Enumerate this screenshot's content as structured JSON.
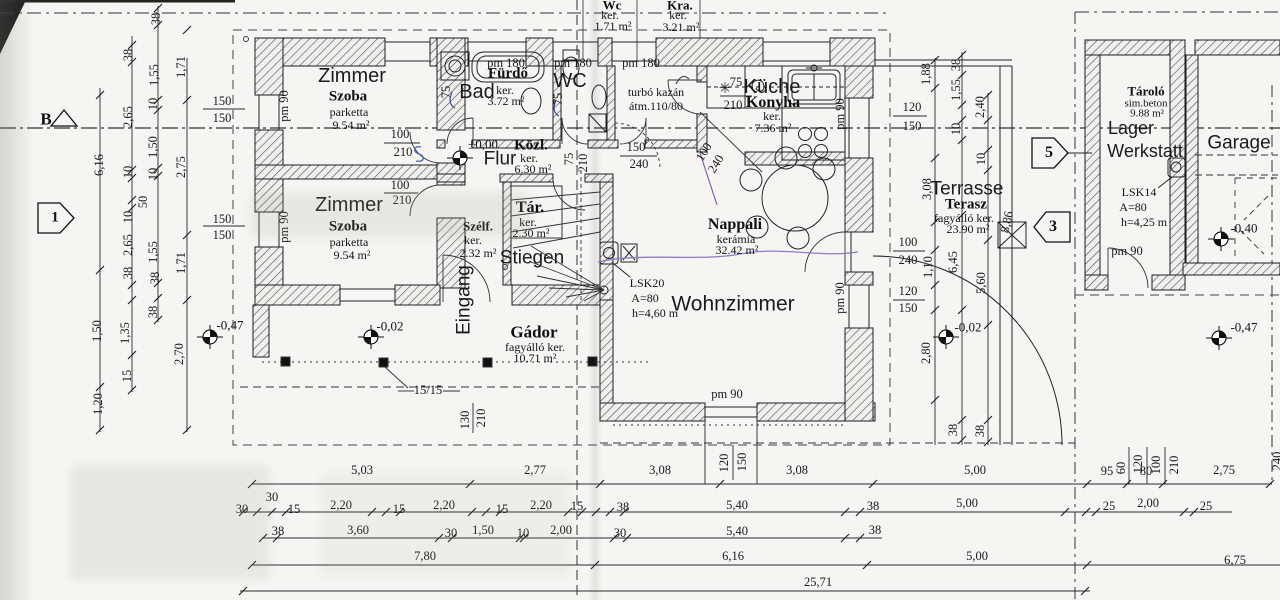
{
  "markers": {
    "section": "B",
    "node1": "1",
    "node3": "3",
    "node5": "5"
  },
  "rooms": {
    "zimmer1": {
      "name_de": "Zimmer",
      "name_hu": "Szoba",
      "floor": "parketta",
      "area": "9.54 m²"
    },
    "zimmer2": {
      "name_de": "Zimmer",
      "name_hu": "Szoba",
      "floor": "parketta",
      "area": "9.54 m²"
    },
    "bad": {
      "name_hu": "Fürdő",
      "name_de": "Bad",
      "floor": "ker.",
      "area": "3.72 m²"
    },
    "wc": {
      "name_de": "WC"
    },
    "wc_small": {
      "name_hu": "Wc",
      "floor": "ker.",
      "area": "1.71 m²"
    },
    "kra": {
      "name_hu": "Kra.",
      "floor": "ker.",
      "area": "3.21 m²"
    },
    "boiler": {
      "line1": "turbó kazán",
      "line2": "átm.110/80"
    },
    "kueche": {
      "name_de": "Küche",
      "name_hu": "Konyha",
      "floor": "ker.",
      "area": "7.36 m²"
    },
    "koezl": {
      "name_hu": "Közl.",
      "floor": "ker.",
      "area": "6.30 m²"
    },
    "flur": {
      "level": "±0,00",
      "name_de": "Flur"
    },
    "szelf": {
      "name_hu": "Szélf.",
      "floor": "ker.",
      "area": "2.32 m²"
    },
    "tar": {
      "name_hu": "Tár.",
      "floor": "ker.",
      "area": "2.30 m²"
    },
    "stiegen": {
      "name_de": "Stiegen"
    },
    "eingang": {
      "name_de": "Eingang"
    },
    "nappali": {
      "name_hu": "Nappali",
      "floor": "kerámia",
      "area": "32.42 m²"
    },
    "wohnzimmer": {
      "name_de": "Wohnzimmer"
    },
    "gador": {
      "name_hu": "Gádor",
      "floor": "fagyálló ker.",
      "area": "10.71 m²"
    },
    "terrasse": {
      "name_de": "Terrasse",
      "name_hu": "Terasz",
      "floor": "fagyálló ker.",
      "area": "23.90 m²"
    },
    "tarolo": {
      "name_hu": "Tároló",
      "floor": "sim.beton",
      "area": "9.88 m²"
    },
    "lager": {
      "line1": "Lager",
      "line2": "Werkstatt"
    },
    "garage": {
      "name_de": "Garage"
    }
  },
  "annotations": {
    "lsk20": {
      "l1": "LSK20",
      "l2": "A=80",
      "l3": "h=4,60 m"
    },
    "lsk14": {
      "l1": "LSK14",
      "l2": "A=80",
      "l3": "h=4,25 m"
    }
  },
  "levels": {
    "flur": "±0,00",
    "porch_left": "-0,47",
    "porch": "-0,02",
    "terrace": "-0,02",
    "garage": "-0,40",
    "east": "-0,47"
  },
  "dim_labels": [
    {
      "t": "6,16",
      "x": 99,
      "y": 165,
      "r": -90
    },
    {
      "t": "1,50",
      "x": 97,
      "y": 331,
      "r": -90
    },
    {
      "t": "1,20",
      "x": 98,
      "y": 404,
      "r": -90
    },
    {
      "t": "38",
      "x": 128,
      "y": 55,
      "r": -90
    },
    {
      "t": "2,65",
      "x": 128,
      "y": 117,
      "r": -90
    },
    {
      "t": "10",
      "x": 128,
      "y": 172,
      "r": -90
    },
    {
      "t": "50",
      "x": 143,
      "y": 202,
      "r": -90
    },
    {
      "t": "10",
      "x": 128,
      "y": 217,
      "r": -90
    },
    {
      "t": "2,65",
      "x": 128,
      "y": 245,
      "r": -90
    },
    {
      "t": "38",
      "x": 128,
      "y": 273,
      "r": -90
    },
    {
      "t": "1,35",
      "x": 125,
      "y": 333,
      "r": -90
    },
    {
      "t": "15",
      "x": 127,
      "y": 376,
      "r": -90
    },
    {
      "t": "38",
      "x": 156,
      "y": 19,
      "r": -90
    },
    {
      "t": "1,55",
      "x": 154,
      "y": 75,
      "r": -90
    },
    {
      "t": "10",
      "x": 153,
      "y": 104,
      "r": -90
    },
    {
      "t": "1,50",
      "x": 153,
      "y": 147,
      "r": -90
    },
    {
      "t": "10",
      "x": 153,
      "y": 174,
      "r": -90
    },
    {
      "t": "1,55",
      "x": 153,
      "y": 252,
      "r": -90
    },
    {
      "t": "38",
      "x": 155,
      "y": 278,
      "r": -90
    },
    {
      "t": "38",
      "x": 153,
      "y": 312,
      "r": -90
    },
    {
      "t": "1,71",
      "x": 181,
      "y": 67,
      "r": -90
    },
    {
      "t": "2,75",
      "x": 181,
      "y": 167,
      "r": -90
    },
    {
      "t": "1,71",
      "x": 181,
      "y": 263,
      "r": -90
    },
    {
      "t": "2,70",
      "x": 179,
      "y": 354,
      "r": -90
    },
    {
      "t": "150",
      "x": 222,
      "y": 101
    },
    {
      "t": "150",
      "x": 222,
      "y": 118
    },
    {
      "t": "150",
      "x": 222,
      "y": 219
    },
    {
      "t": "150",
      "x": 222,
      "y": 235
    },
    {
      "t": "100",
      "x": 400,
      "y": 134
    },
    {
      "t": "210",
      "x": 403,
      "y": 152
    },
    {
      "t": "100",
      "x": 400,
      "y": 185
    },
    {
      "t": "210",
      "x": 402,
      "y": 200
    },
    {
      "t": "150",
      "x": 636,
      "y": 147
    },
    {
      "t": "240",
      "x": 639,
      "y": 164
    },
    {
      "t": "100",
      "x": 704,
      "y": 152,
      "r": -58
    },
    {
      "t": "240",
      "x": 716,
      "y": 164,
      "r": -58
    },
    {
      "t": "75",
      "x": 736,
      "y": 82
    },
    {
      "t": "210",
      "x": 733,
      "y": 105
    },
    {
      "t": "75",
      "x": 569,
      "y": 159,
      "r": -90
    },
    {
      "t": "210",
      "x": 583,
      "y": 163,
      "r": -90
    },
    {
      "t": "75",
      "x": 446,
      "y": 92,
      "r": -90
    },
    {
      "t": "75",
      "x": 558,
      "y": 99,
      "r": -90
    },
    {
      "t": "pm 180",
      "x": 506,
      "y": 63
    },
    {
      "t": "pm 180",
      "x": 573,
      "y": 63
    },
    {
      "t": "pm 180",
      "x": 641,
      "y": 63
    },
    {
      "t": "pm 90",
      "x": 284,
      "y": 106,
      "r": -90
    },
    {
      "t": "pm 90",
      "x": 284,
      "y": 227,
      "r": -90
    },
    {
      "t": "pm 90",
      "x": 840,
      "y": 114,
      "r": -90
    },
    {
      "t": "pm 90",
      "x": 840,
      "y": 298,
      "r": -90
    },
    {
      "t": "pm 90",
      "x": 727,
      "y": 394
    },
    {
      "t": "pm 90",
      "x": 1127,
      "y": 251
    },
    {
      "t": "120",
      "x": 912,
      "y": 107
    },
    {
      "t": "150",
      "x": 912,
      "y": 126
    },
    {
      "t": "100",
      "x": 908,
      "y": 242
    },
    {
      "t": "240",
      "x": 908,
      "y": 260
    },
    {
      "t": "120",
      "x": 908,
      "y": 291
    },
    {
      "t": "150",
      "x": 908,
      "y": 308
    },
    {
      "t": "1,88",
      "x": 926,
      "y": 74,
      "r": -90
    },
    {
      "t": "38",
      "x": 956,
      "y": 65,
      "r": -90
    },
    {
      "t": "1,55",
      "x": 956,
      "y": 90,
      "r": -90
    },
    {
      "t": "2,40",
      "x": 980,
      "y": 107,
      "r": -90
    },
    {
      "t": "10",
      "x": 956,
      "y": 129,
      "r": -90
    },
    {
      "t": "10",
      "x": 981,
      "y": 159,
      "r": -90
    },
    {
      "t": "3,08",
      "x": 927,
      "y": 189,
      "r": -90
    },
    {
      "t": "8,86",
      "x": 1007,
      "y": 222,
      "r": -78
    },
    {
      "t": "1,10",
      "x": 928,
      "y": 267,
      "r": -90
    },
    {
      "t": "6,45",
      "x": 953,
      "y": 262,
      "r": -90
    },
    {
      "t": "5,60",
      "x": 981,
      "y": 283,
      "r": -90
    },
    {
      "t": "2,80",
      "x": 926,
      "y": 353,
      "r": -90
    },
    {
      "t": "38",
      "x": 953,
      "y": 430,
      "r": -90
    },
    {
      "t": "38",
      "x": 980,
      "y": 431,
      "r": -90
    },
    {
      "t": "130",
      "x": 465,
      "y": 420,
      "r": -90
    },
    {
      "t": "210",
      "x": 481,
      "y": 418,
      "r": -90
    },
    {
      "t": "120",
      "x": 724,
      "y": 463,
      "r": -90
    },
    {
      "t": "150",
      "x": 742,
      "y": 462,
      "r": -90
    },
    {
      "t": "15/15",
      "x": 428,
      "y": 390
    },
    {
      "t": "60",
      "x": 1121,
      "y": 468,
      "r": -90
    },
    {
      "t": "120",
      "x": 1138,
      "y": 464,
      "r": -90
    },
    {
      "t": "100",
      "x": 1156,
      "y": 465,
      "r": -90
    },
    {
      "t": "210",
      "x": 1174,
      "y": 465,
      "r": -90
    },
    {
      "t": "240",
      "x": 1277,
      "y": 461,
      "r": -90
    },
    {
      "t": "5,03",
      "x": 362,
      "y": 470
    },
    {
      "t": "2,77",
      "x": 535,
      "y": 470
    },
    {
      "t": "3,08",
      "x": 660,
      "y": 470
    },
    {
      "t": "3,08",
      "x": 797,
      "y": 470
    },
    {
      "t": "5,00",
      "x": 975,
      "y": 470
    },
    {
      "t": "95",
      "x": 1107,
      "y": 471
    },
    {
      "t": "80",
      "x": 1146,
      "y": 471
    },
    {
      "t": "2,75",
      "x": 1224,
      "y": 470
    },
    {
      "t": "30",
      "x": 272,
      "y": 497
    },
    {
      "t": "30",
      "x": 242,
      "y": 509
    },
    {
      "t": "15",
      "x": 294,
      "y": 509
    },
    {
      "t": "2,20",
      "x": 341,
      "y": 505
    },
    {
      "t": "15",
      "x": 399,
      "y": 509
    },
    {
      "t": "2,20",
      "x": 444,
      "y": 505
    },
    {
      "t": "15",
      "x": 502,
      "y": 509
    },
    {
      "t": "2,20",
      "x": 541,
      "y": 505
    },
    {
      "t": "15",
      "x": 577,
      "y": 506
    },
    {
      "t": "38",
      "x": 623,
      "y": 507
    },
    {
      "t": "5,40",
      "x": 737,
      "y": 505
    },
    {
      "t": "38",
      "x": 873,
      "y": 506
    },
    {
      "t": "5,00",
      "x": 967,
      "y": 503
    },
    {
      "t": "25",
      "x": 1109,
      "y": 506
    },
    {
      "t": "2,00",
      "x": 1148,
      "y": 503
    },
    {
      "t": "25",
      "x": 1206,
      "y": 506
    },
    {
      "t": "38",
      "x": 278,
      "y": 531
    },
    {
      "t": "3,60",
      "x": 358,
      "y": 530
    },
    {
      "t": "30",
      "x": 451,
      "y": 533
    },
    {
      "t": "1,50",
      "x": 483,
      "y": 530
    },
    {
      "t": "10",
      "x": 523,
      "y": 533
    },
    {
      "t": "2,00",
      "x": 561,
      "y": 530
    },
    {
      "t": "30",
      "x": 620,
      "y": 533
    },
    {
      "t": "5,40",
      "x": 737,
      "y": 531
    },
    {
      "t": "38",
      "x": 875,
      "y": 530
    },
    {
      "t": "7,80",
      "x": 425,
      "y": 556
    },
    {
      "t": "6,16",
      "x": 733,
      "y": 556
    },
    {
      "t": "5,00",
      "x": 977,
      "y": 556
    },
    {
      "t": "6,75",
      "x": 1235,
      "y": 560
    },
    {
      "t": "25,71",
      "x": 818,
      "y": 582
    }
  ]
}
